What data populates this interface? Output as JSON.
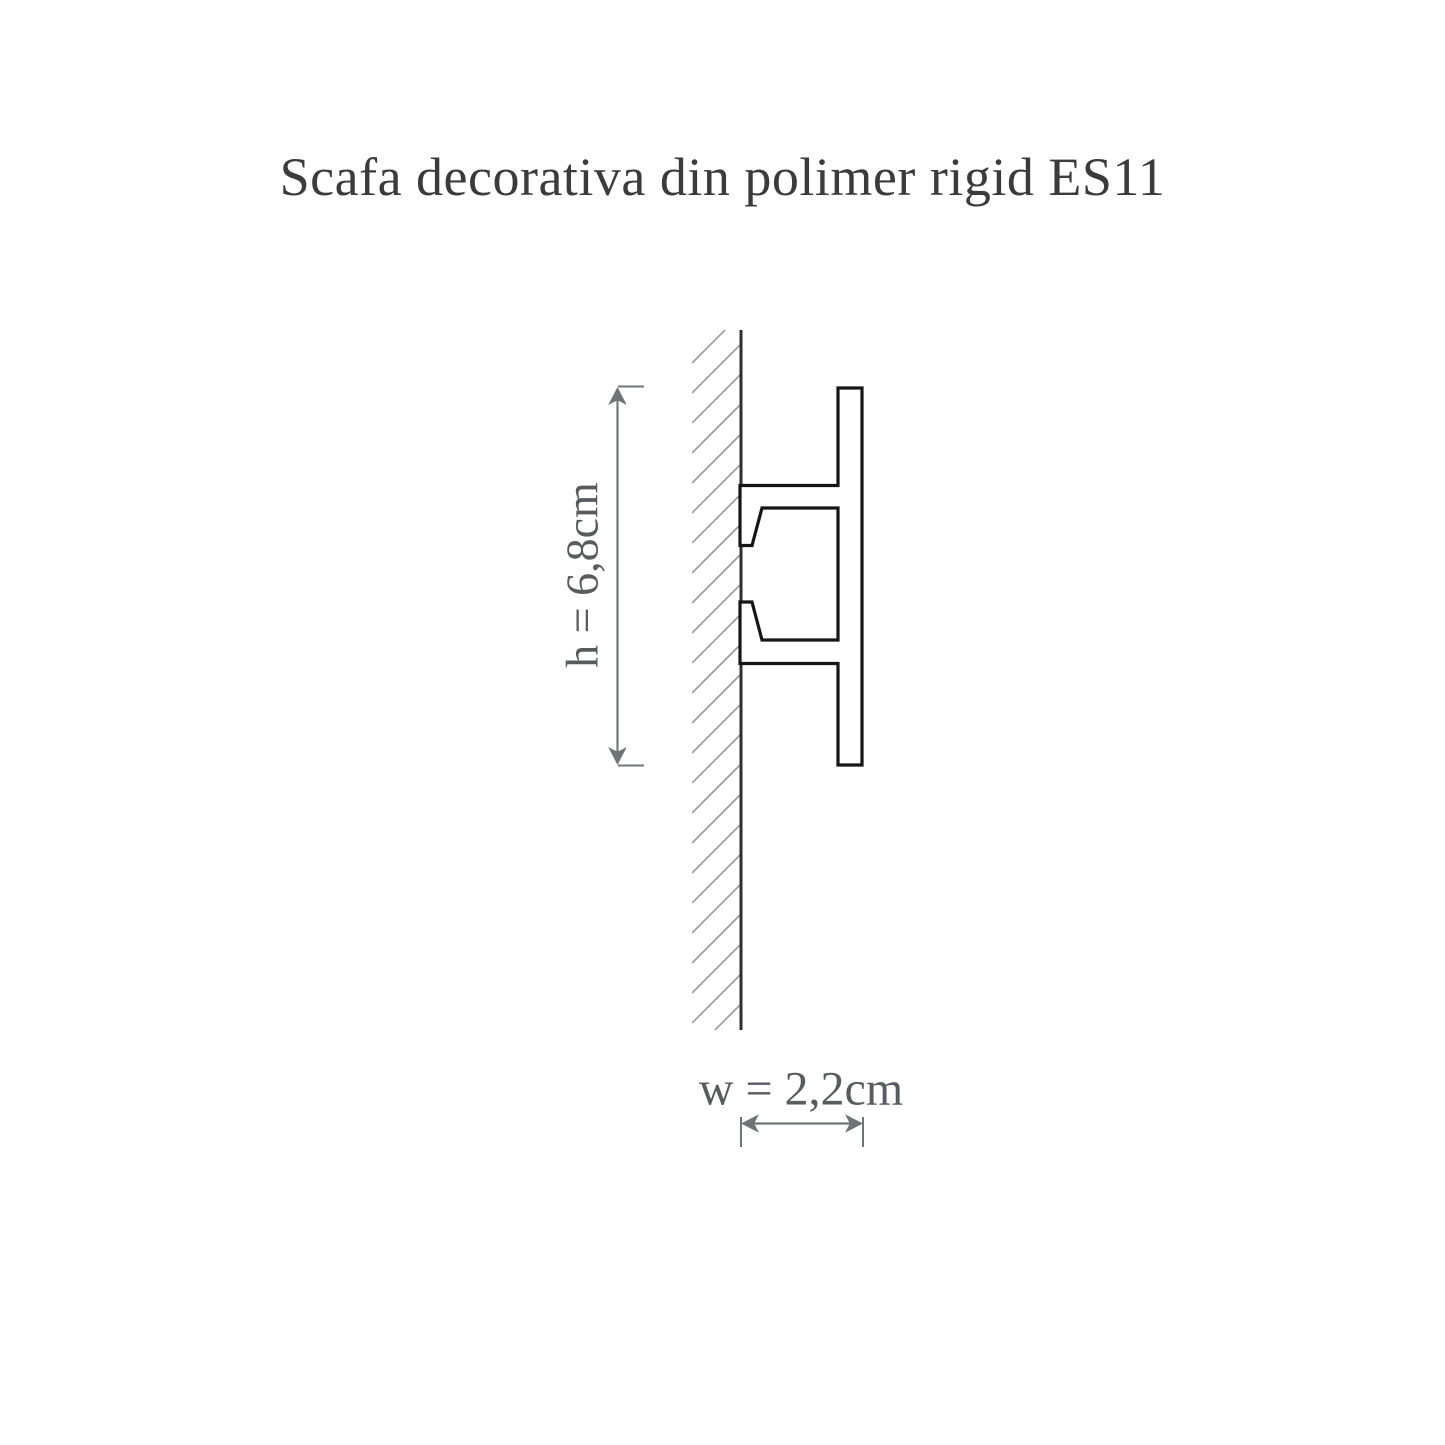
{
  "title": "Scafa decorativa din polimer rigid ES11",
  "dimensions": {
    "height_label": "h = 6,8cm",
    "width_label": "w = 2,2cm"
  },
  "colors": {
    "background": "#ffffff",
    "title_text": "#3b3b3b",
    "dimension_text": "#595b5e",
    "dimension_line": "#717477",
    "profile_outline": "#161616",
    "profile_fill": "#ffffff",
    "wall_line": "#2f2f2f",
    "hatch_line": "#9a9a9a"
  }
}
